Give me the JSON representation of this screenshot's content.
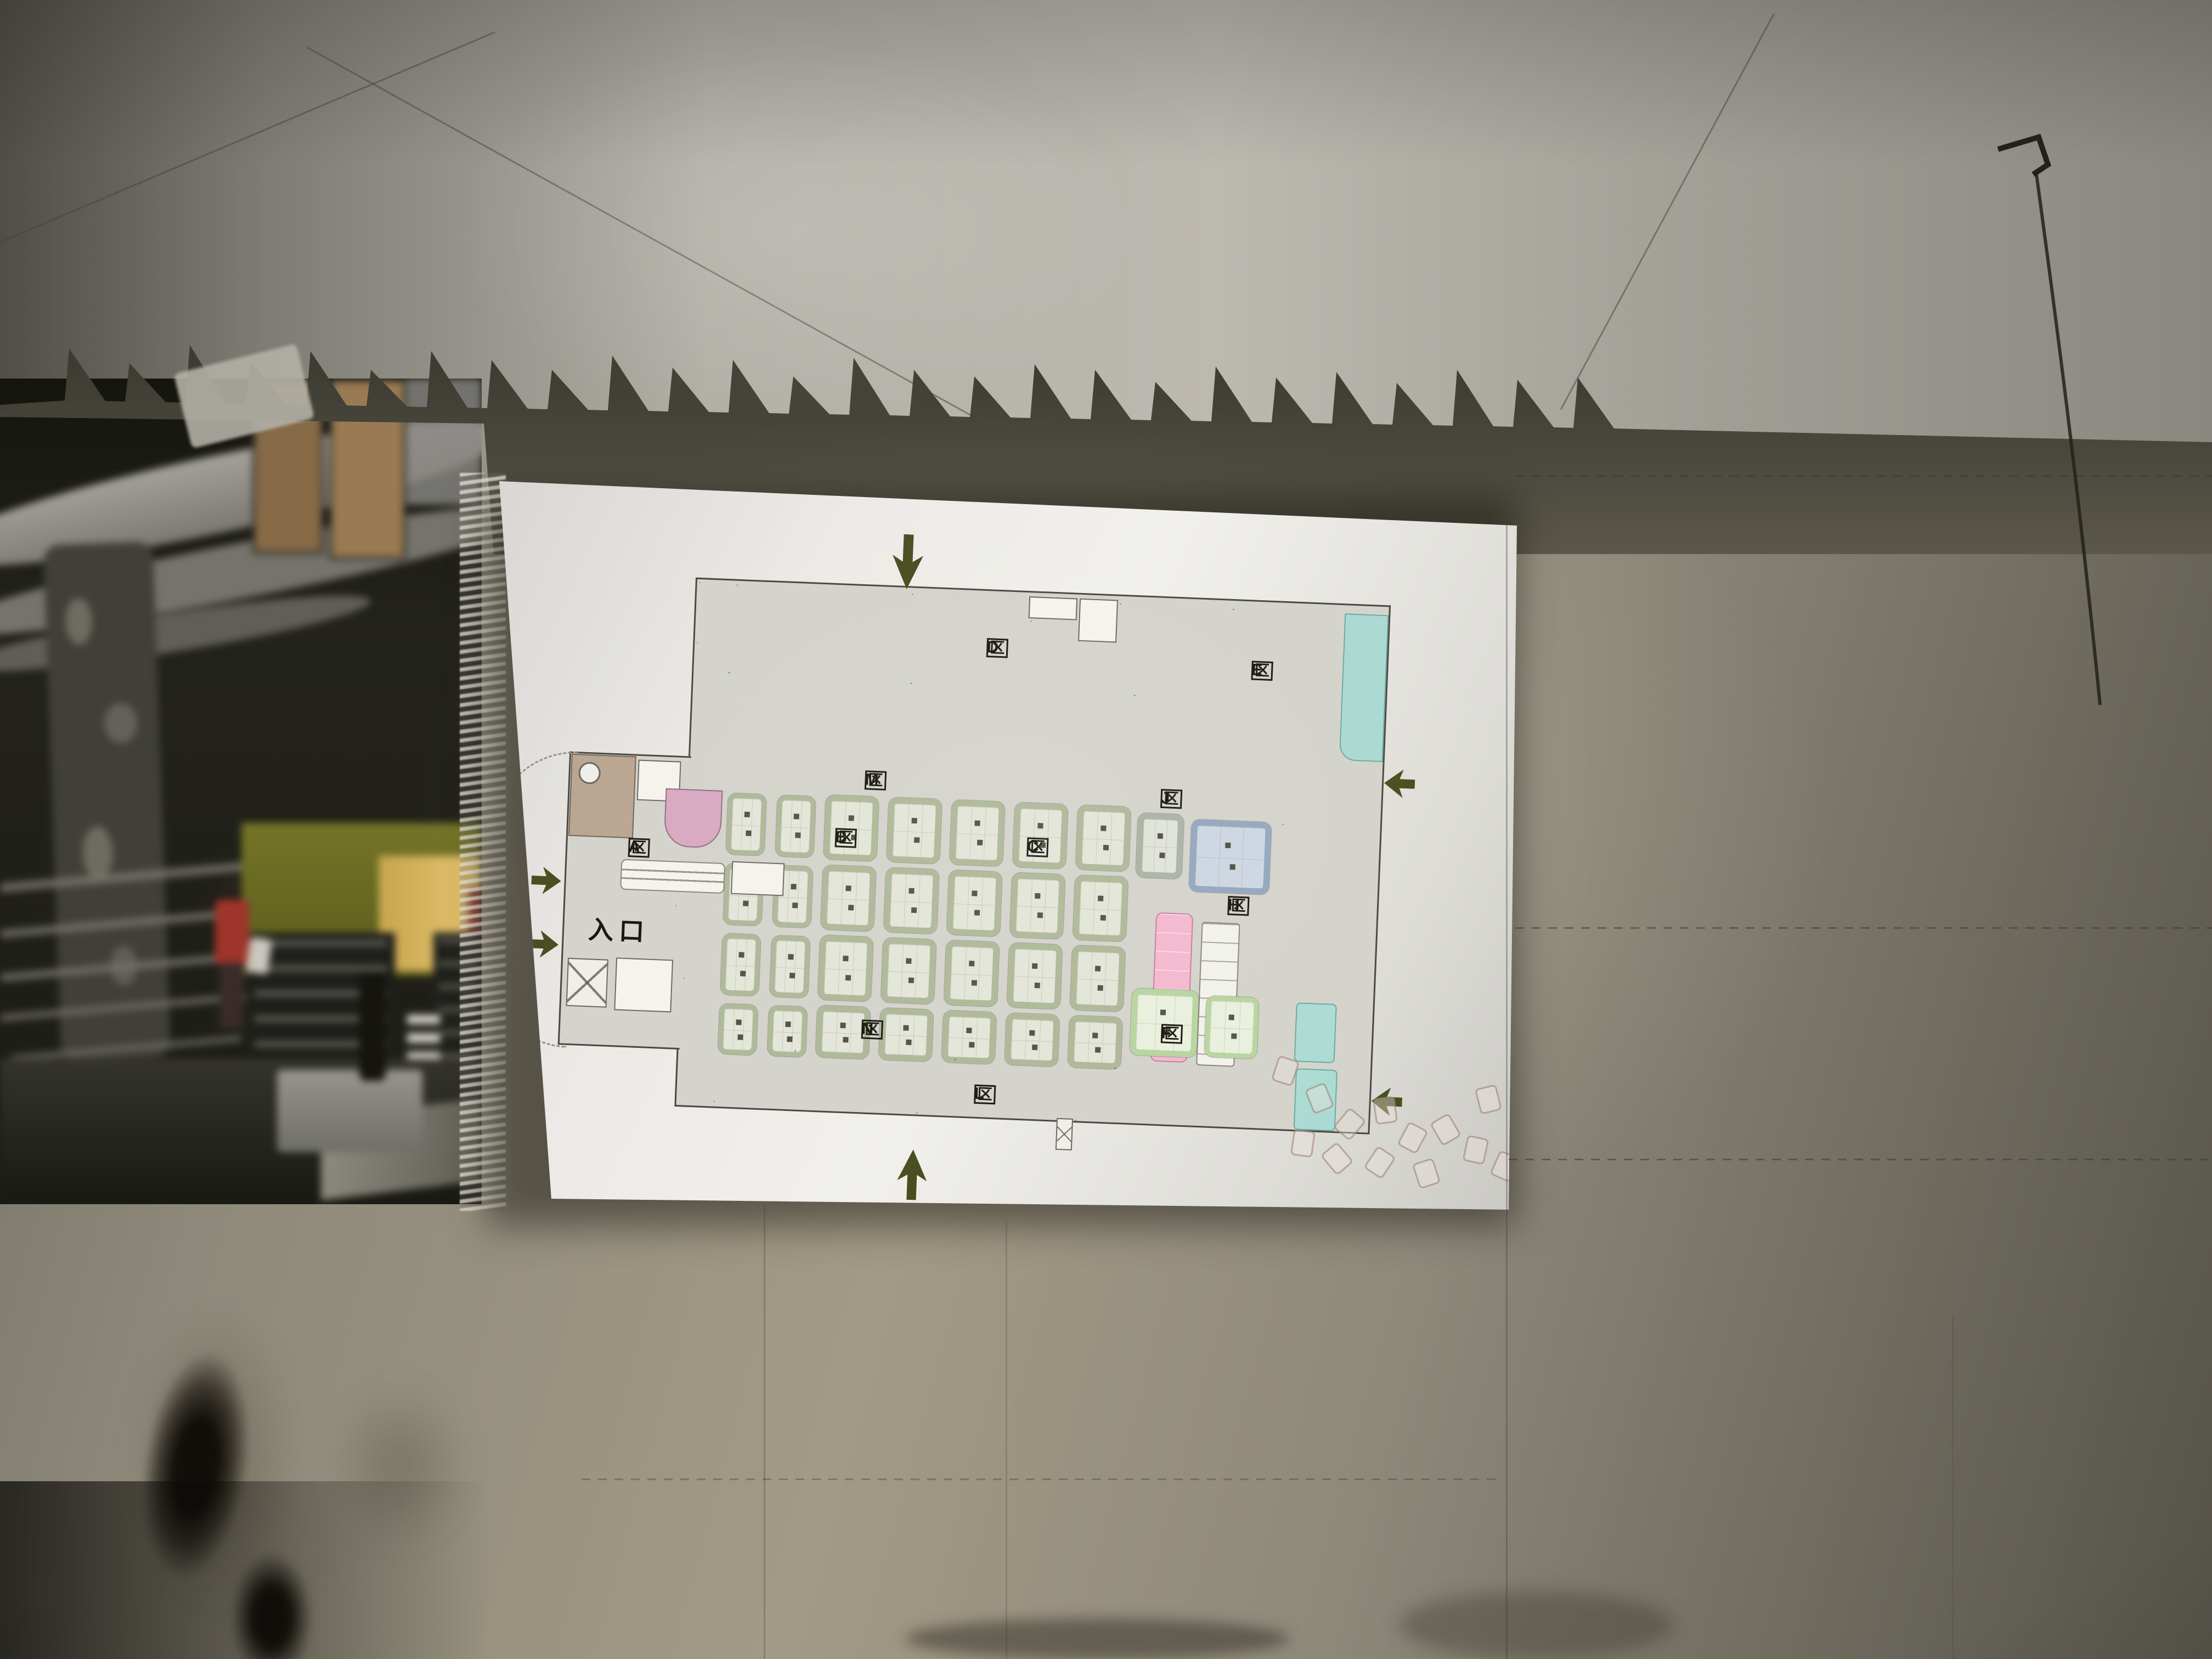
{
  "floor_plan": {
    "entrance_label": "入口",
    "zone_box_char": "区",
    "zones": [
      {
        "letter": "A"
      },
      {
        "letter": "B"
      },
      {
        "letter": "C"
      },
      {
        "letter": "D"
      },
      {
        "letter": "E"
      },
      {
        "letter": "F"
      },
      {
        "letter": "H"
      },
      {
        "letter": "J"
      },
      {
        "letter": "L"
      },
      {
        "letter": "M"
      },
      {
        "letter": "N"
      }
    ],
    "palette": {
      "board_bg": "#eceae6",
      "plan_floor": "#d3d3cc",
      "wall_line": "#4a443e",
      "yellow_stall": "#e9c85d",
      "blue_stall": "#93a7cf",
      "green_block_border": "#adb898",
      "green_block_center": "#e2e5d8",
      "brown_stall": "#b98f74",
      "purple_stall": "#b3abc9",
      "lavender_stall": "#cdc7dc",
      "pink_block": "#f3b7cf",
      "teal_block": "#aadbd4",
      "light_green_block": "#e8f0dd",
      "arrow_green": "#474c1d",
      "photo_wall": "#8e897a",
      "photo_ceiling": "#b2afa7",
      "photo_dark_scene": "#1c1c16"
    }
  }
}
